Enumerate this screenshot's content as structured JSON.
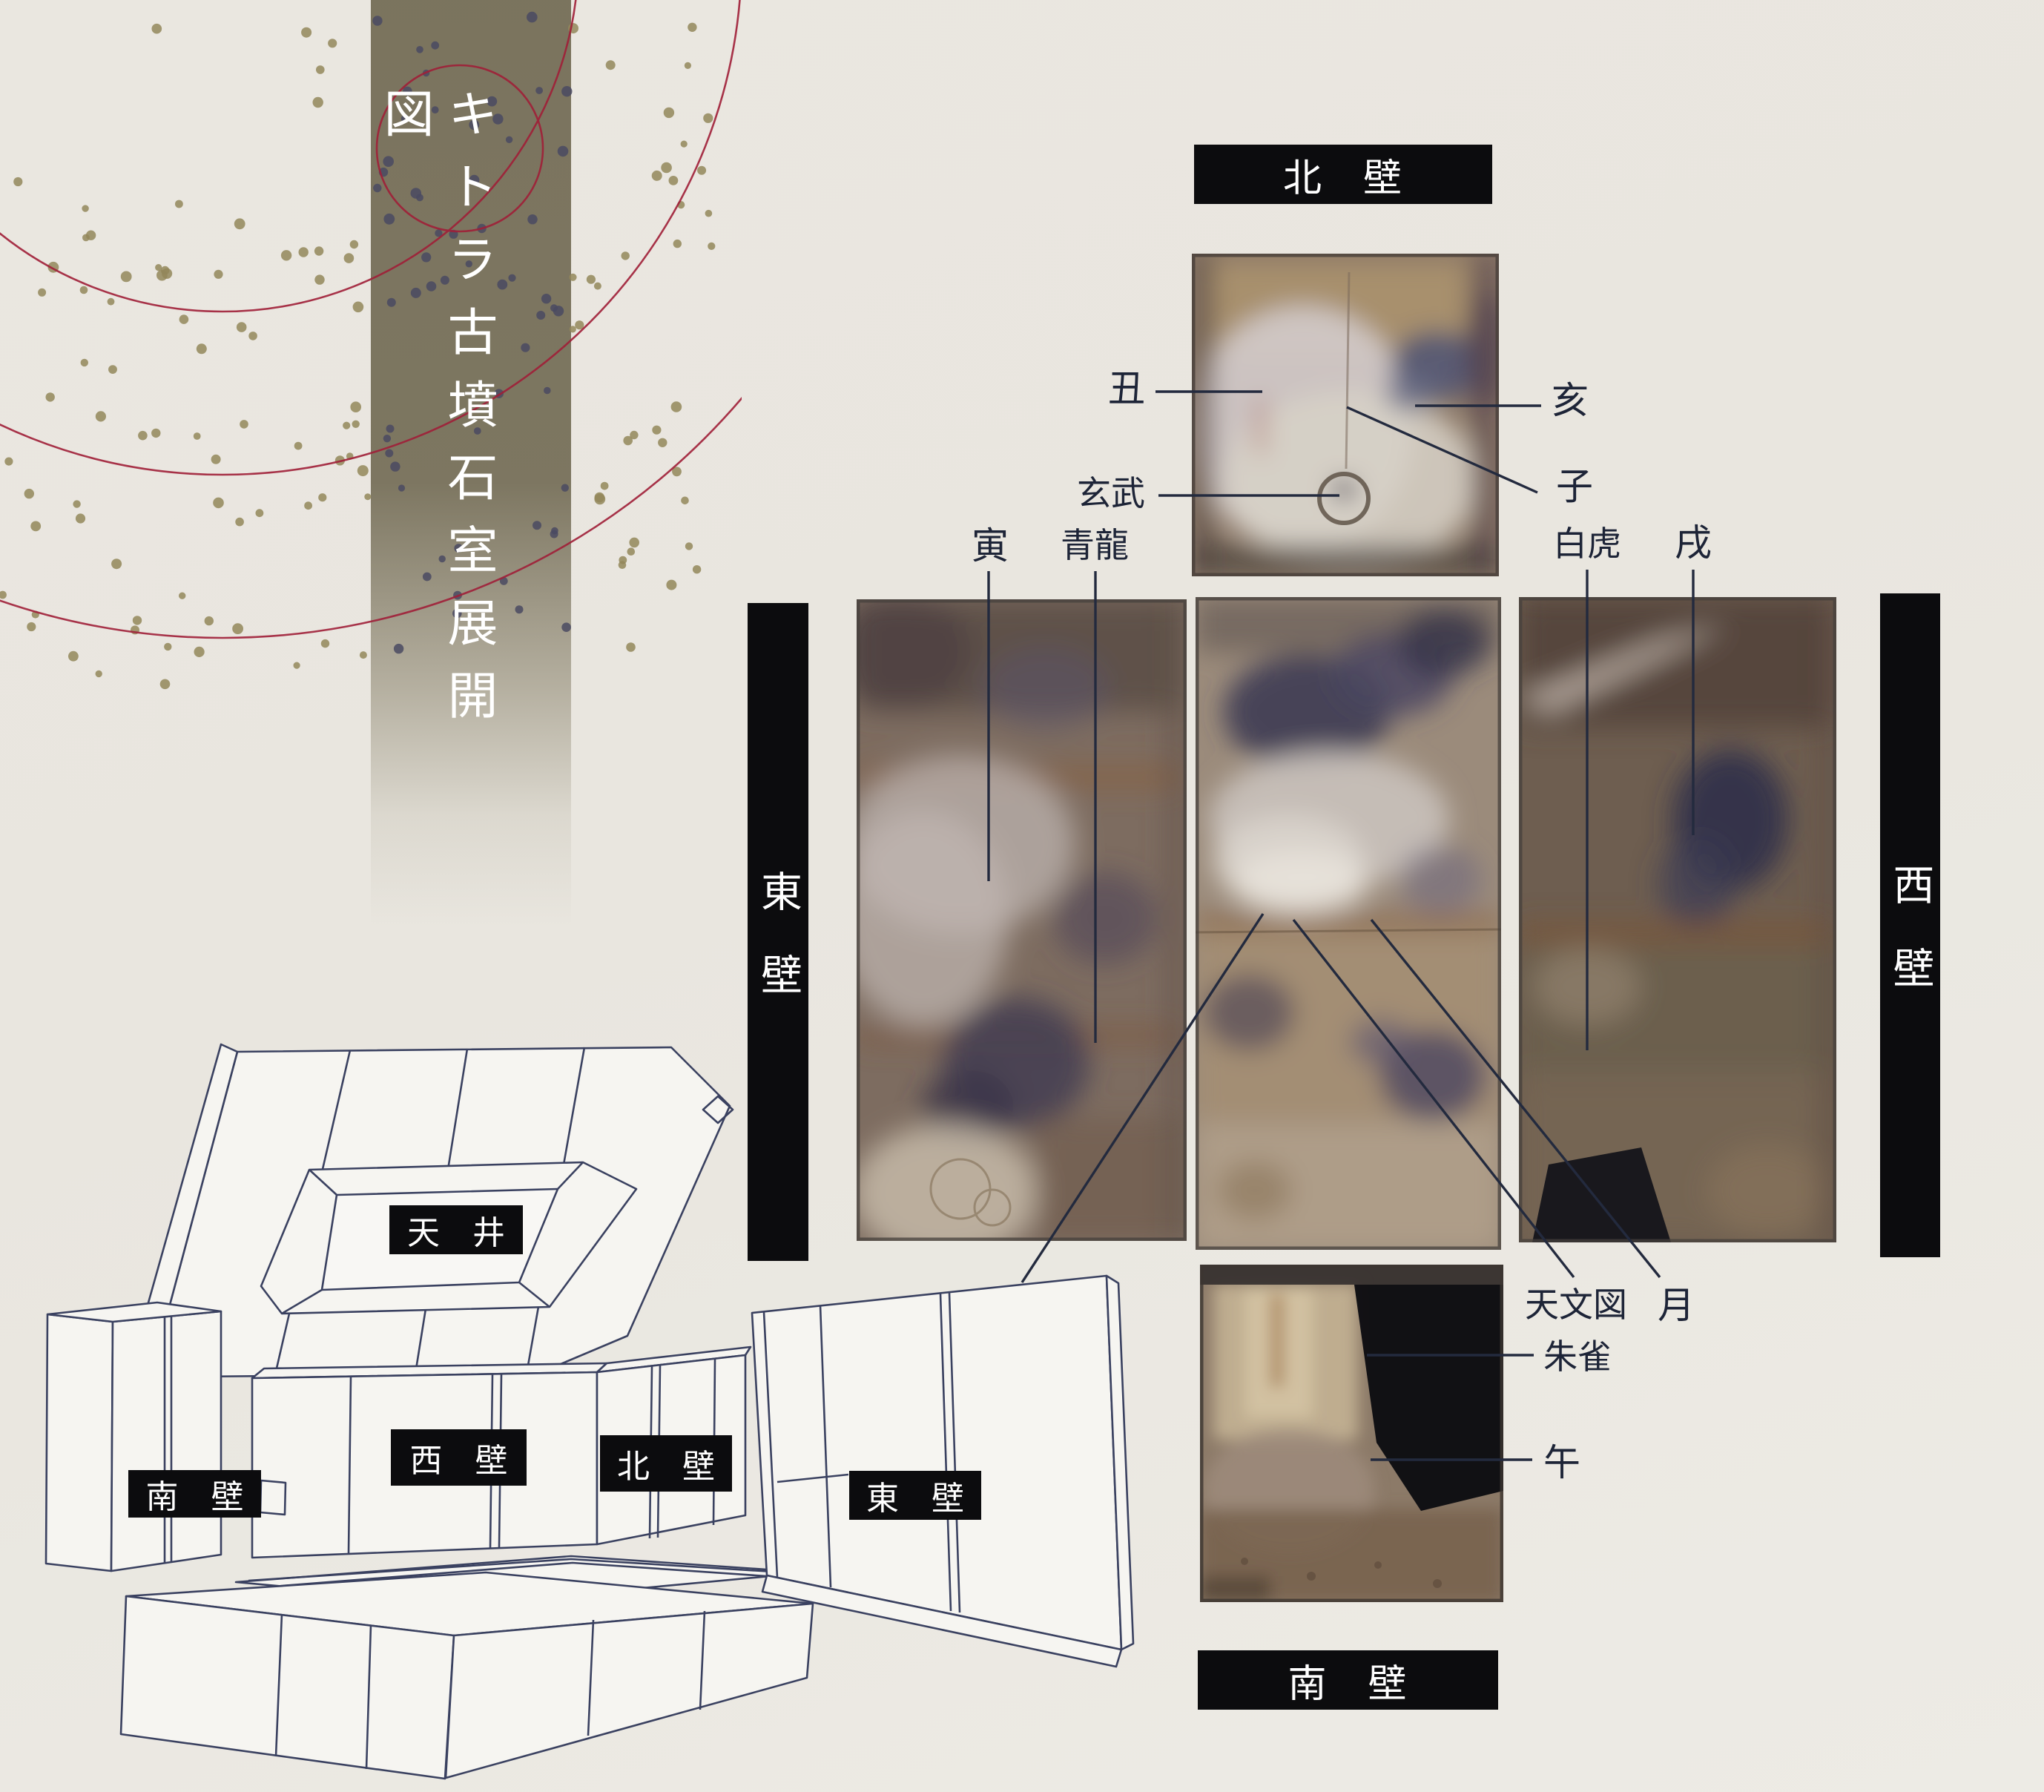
{
  "title": {
    "text": "キトラ古墳石室展開図"
  },
  "walls": {
    "north_header": "北　壁",
    "south_header": "南　壁",
    "east_header": "東壁",
    "west_header": "西壁"
  },
  "annotations": {
    "ushi": "丑",
    "i": "亥",
    "ne": "子",
    "genbu": "玄武",
    "tora": "寅",
    "seiryu": "青龍",
    "byakko": "白虎",
    "inu": "戌",
    "sun": "日",
    "tenmonzu": "天文図",
    "moon": "月",
    "suzaku": "朱雀",
    "uma": "午"
  },
  "model3d": {
    "ceiling": "天　井",
    "west": "西　壁",
    "north": "北　壁",
    "south": "南　壁",
    "east": "東　壁"
  },
  "colors": {
    "background": "#e9e6df",
    "band": "#77705a",
    "label_bar": "#0c0c0e",
    "bar_text": "#ffffff",
    "annotation_text": "#1d2437",
    "leader_line": "#232a3e",
    "circle_red": "#a01f38",
    "dot_gold": "#93875a",
    "dot_dark": "#4a4a62",
    "line_art": "#3a4160"
  }
}
